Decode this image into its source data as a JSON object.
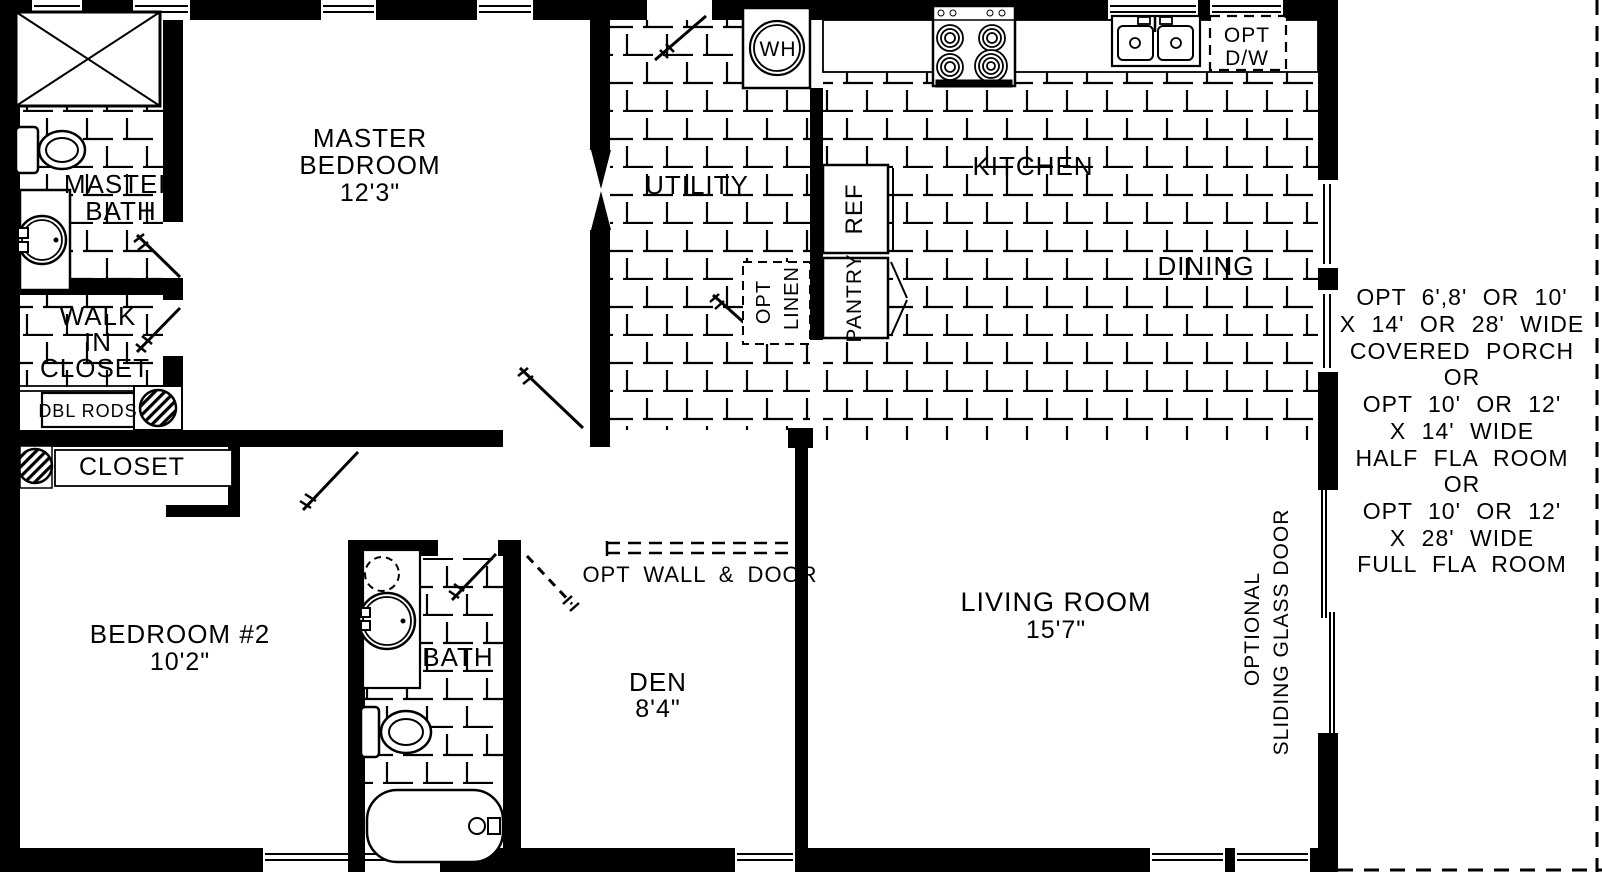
{
  "plan": {
    "rooms": {
      "master_bath": {
        "l1": "MASTER",
        "l2": "BATH"
      },
      "master_bedroom": {
        "l1": "MASTER",
        "l2": "BEDROOM",
        "dim": "12'3\""
      },
      "walk_in_closet": {
        "l1": "WALK",
        "l2": "IN",
        "l3": "CLOSET"
      },
      "closet2": {
        "label": "CLOSET"
      },
      "bedroom2": {
        "l1": "BEDROOM #2",
        "dim": "10'2\""
      },
      "bath2": {
        "label": "BATH"
      },
      "den": {
        "label": "DEN",
        "dim": "8'4\""
      },
      "utility": {
        "label": "UTILITY"
      },
      "kitchen": {
        "label": "KITCHEN"
      },
      "dining": {
        "label": "DINING"
      },
      "living_room": {
        "l1": "LIVING ROOM",
        "dim": "15'7\""
      }
    },
    "fixtures": {
      "water_heater": "WH",
      "refrigerator": "REF",
      "pantry": "PANTRY",
      "dbl_rods": "DBL RODS",
      "opt_linen": {
        "l1": "OPT",
        "l2": "LINEN"
      },
      "opt_dishwasher": {
        "l1": "OPT",
        "l2": "D/W"
      }
    },
    "annotations": {
      "opt_wall_door": "OPT WALL & DOOR",
      "sliding_door": {
        "l1": "OPTIONAL",
        "l2": "SLIDING GLASS DOOR"
      },
      "porch_options": {
        "lines": [
          "OPT 6',8' OR 10'",
          "X 14' OR 28' WIDE",
          "COVERED PORCH",
          "OR",
          "OPT 10' OR 12'",
          "X 14' WIDE",
          "HALF FLA ROOM",
          "OR",
          "OPT 10' OR 12'",
          "X 28' WIDE",
          "FULL FLA ROOM"
        ]
      }
    },
    "colors": {
      "ink": "#000000",
      "paper": "#ffffff"
    }
  }
}
